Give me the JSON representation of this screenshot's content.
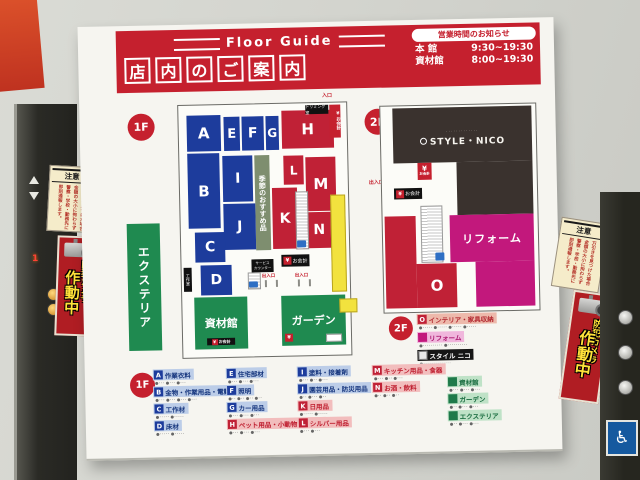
{
  "header": {
    "floor_guide": "Floor Guide",
    "title_chars": [
      "店",
      "内",
      "の",
      "ご",
      "案",
      "内"
    ],
    "hours_title": "営業時間のお知らせ",
    "hours": [
      {
        "label": "本 館",
        "time": "9:30~19:30"
      },
      {
        "label": "資材館",
        "time": "8:00~19:30"
      }
    ]
  },
  "map1f": {
    "badge": "1F",
    "blocks": {
      "A": "A",
      "B": "B",
      "C": "C",
      "D": "D",
      "E": "E",
      "F": "F",
      "G": "G",
      "H": "H",
      "I": "I",
      "J": "J",
      "K": "K",
      "L": "L",
      "M": "M",
      "N": "N"
    },
    "seasonal": "季節のおすすめ品",
    "exterior": "エクステリア",
    "materials_hall": "資材館",
    "garden": "ガーデン",
    "entrance": "入口",
    "trimming_room": "トリミング室",
    "checkout": "お会計",
    "service_counter_1": "サービス",
    "service_counter_2": "カウンター",
    "exit": "出入口",
    "craft_room": "工作室",
    "yen": "¥"
  },
  "map2f": {
    "badge": "2F",
    "brand": "STYLE・NICO",
    "brand_topline": "･････････････",
    "o_label": "O",
    "reform": "リフォーム",
    "checkout": "お会計",
    "exit": "出入口",
    "yen": "¥"
  },
  "legend2f": {
    "badge": "2F",
    "rows": [
      {
        "chip": "O",
        "label": "インテリア・家具収納",
        "sub": "●･････ ●･････ ●･････ ●･････"
      },
      {
        "chip": "",
        "label": "リフォーム",
        "sub": "●･･････････ ●･･････････"
      },
      {
        "chip": "",
        "label": "スタイル ニコ",
        "sub": "●･･････････････"
      }
    ]
  },
  "legend1f": {
    "badge": "1F",
    "items": [
      {
        "chip": "A",
        "label": "作業衣料",
        "sub": "●･･･ ●･･･ ●･･･"
      },
      {
        "chip": "B",
        "label": "金物・作業用品・電動工具",
        "sub": "●･･･ ●･･･ ●･･･ ●･･･"
      },
      {
        "chip": "C",
        "label": "工作材",
        "sub": "●･････ ●･････"
      },
      {
        "chip": "D",
        "label": "床材",
        "sub": "●･････ ●･････"
      },
      {
        "chip": "E",
        "label": "住宅部材",
        "sub": "●･･･ ●･･･ ●･･･"
      },
      {
        "chip": "F",
        "label": "照明",
        "sub": "●･･ ●･･ ●･･ ●･･"
      },
      {
        "chip": "G",
        "label": "カー用品",
        "sub": "●･･･ ●･･･ ●･･･"
      },
      {
        "chip": "H",
        "label": "ペット用品・小動物・アクア",
        "sub": "●･･･ ●･･･ ●･･･"
      },
      {
        "chip": "I",
        "label": "塗料・接着剤",
        "sub": "●･･･ ●･･ ●･･･"
      },
      {
        "chip": "J",
        "label": "園芸用品・防災用品",
        "sub": "●･･ ●･･･ ●･･"
      },
      {
        "chip": "K",
        "label": "日用品",
        "sub": "●･････ ●･････"
      },
      {
        "chip": "L",
        "label": "シルバー用品",
        "sub": "●･･･ ●･･･"
      },
      {
        "chip": "M",
        "label": "キッチン用品・食器",
        "sub": "●･･･ ●･･ ●･･･"
      },
      {
        "chip": "N",
        "label": "お酒・飲料",
        "sub": "●･･ ●･･ ●･･"
      },
      {
        "chip": "",
        "label": "資材館",
        "sub": "●･･･ ●･･･ ●･･･"
      },
      {
        "chip": "",
        "label": "ガーデン",
        "sub": "●･･ ●･･･ ●･･･"
      },
      {
        "chip": "",
        "label": "エクステリア",
        "sub": "●･･ ●･･･ ●･･･"
      }
    ]
  },
  "stickers": {
    "notice_title": "注意",
    "notice_lines": [
      "万引きを見つけた場合",
      "金額の大小に拘わらず",
      "警察・学校・勤務先に",
      "即刻通報します。"
    ],
    "camera_line1": "防犯カメラ",
    "camera_line2": "作動中"
  },
  "elevator": {
    "floor_indicator": "1"
  },
  "icons": {
    "wheelchair": "♿",
    "arrow_right": "→"
  },
  "colors": {
    "accent_red": "#c5202e",
    "block_blue": "#1d3c9c",
    "block_red": "#c02136",
    "block_green": "#1f8a50",
    "reform_magenta": "#c2187c",
    "dark_brown": "#3a322e"
  }
}
